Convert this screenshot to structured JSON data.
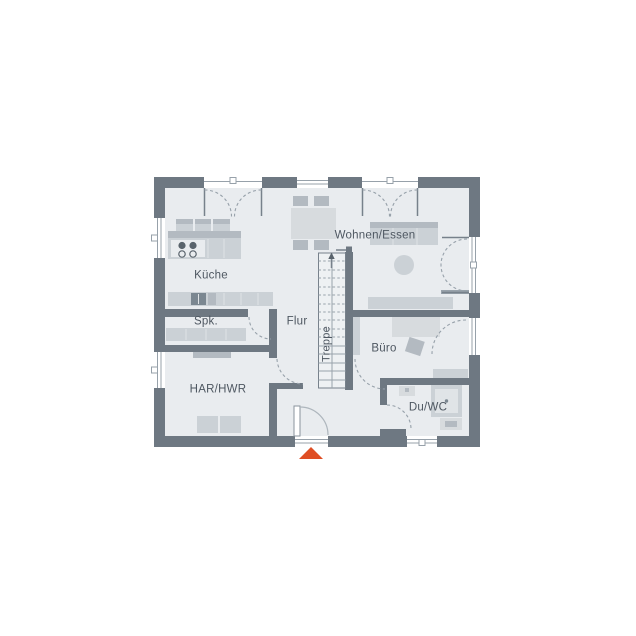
{
  "labels": {
    "kueche": "Küche",
    "wohnen_essen": "Wohnen/Essen",
    "spk": "Spk.",
    "flur": "Flur",
    "treppe": "Treppe",
    "buero": "Büro",
    "har_hwr": "HAR/HWR",
    "du_wc": "Du/WC"
  },
  "colors": {
    "background": "#ffffff",
    "wall": "#6e7882",
    "floor": "#e9ecef",
    "furniture_light": "#d7dbde",
    "furniture_mid": "#cbd1d6",
    "furniture_dark": "#b3bac1",
    "appliance_dark": "#7b8791",
    "door_arc": "#97a1aa",
    "label_text": "#4e5761",
    "entrance_marker": "#df4e24"
  },
  "icons": {
    "entrance_arrow": "triangle-up-marker",
    "stair_direction": "arrow-up"
  }
}
